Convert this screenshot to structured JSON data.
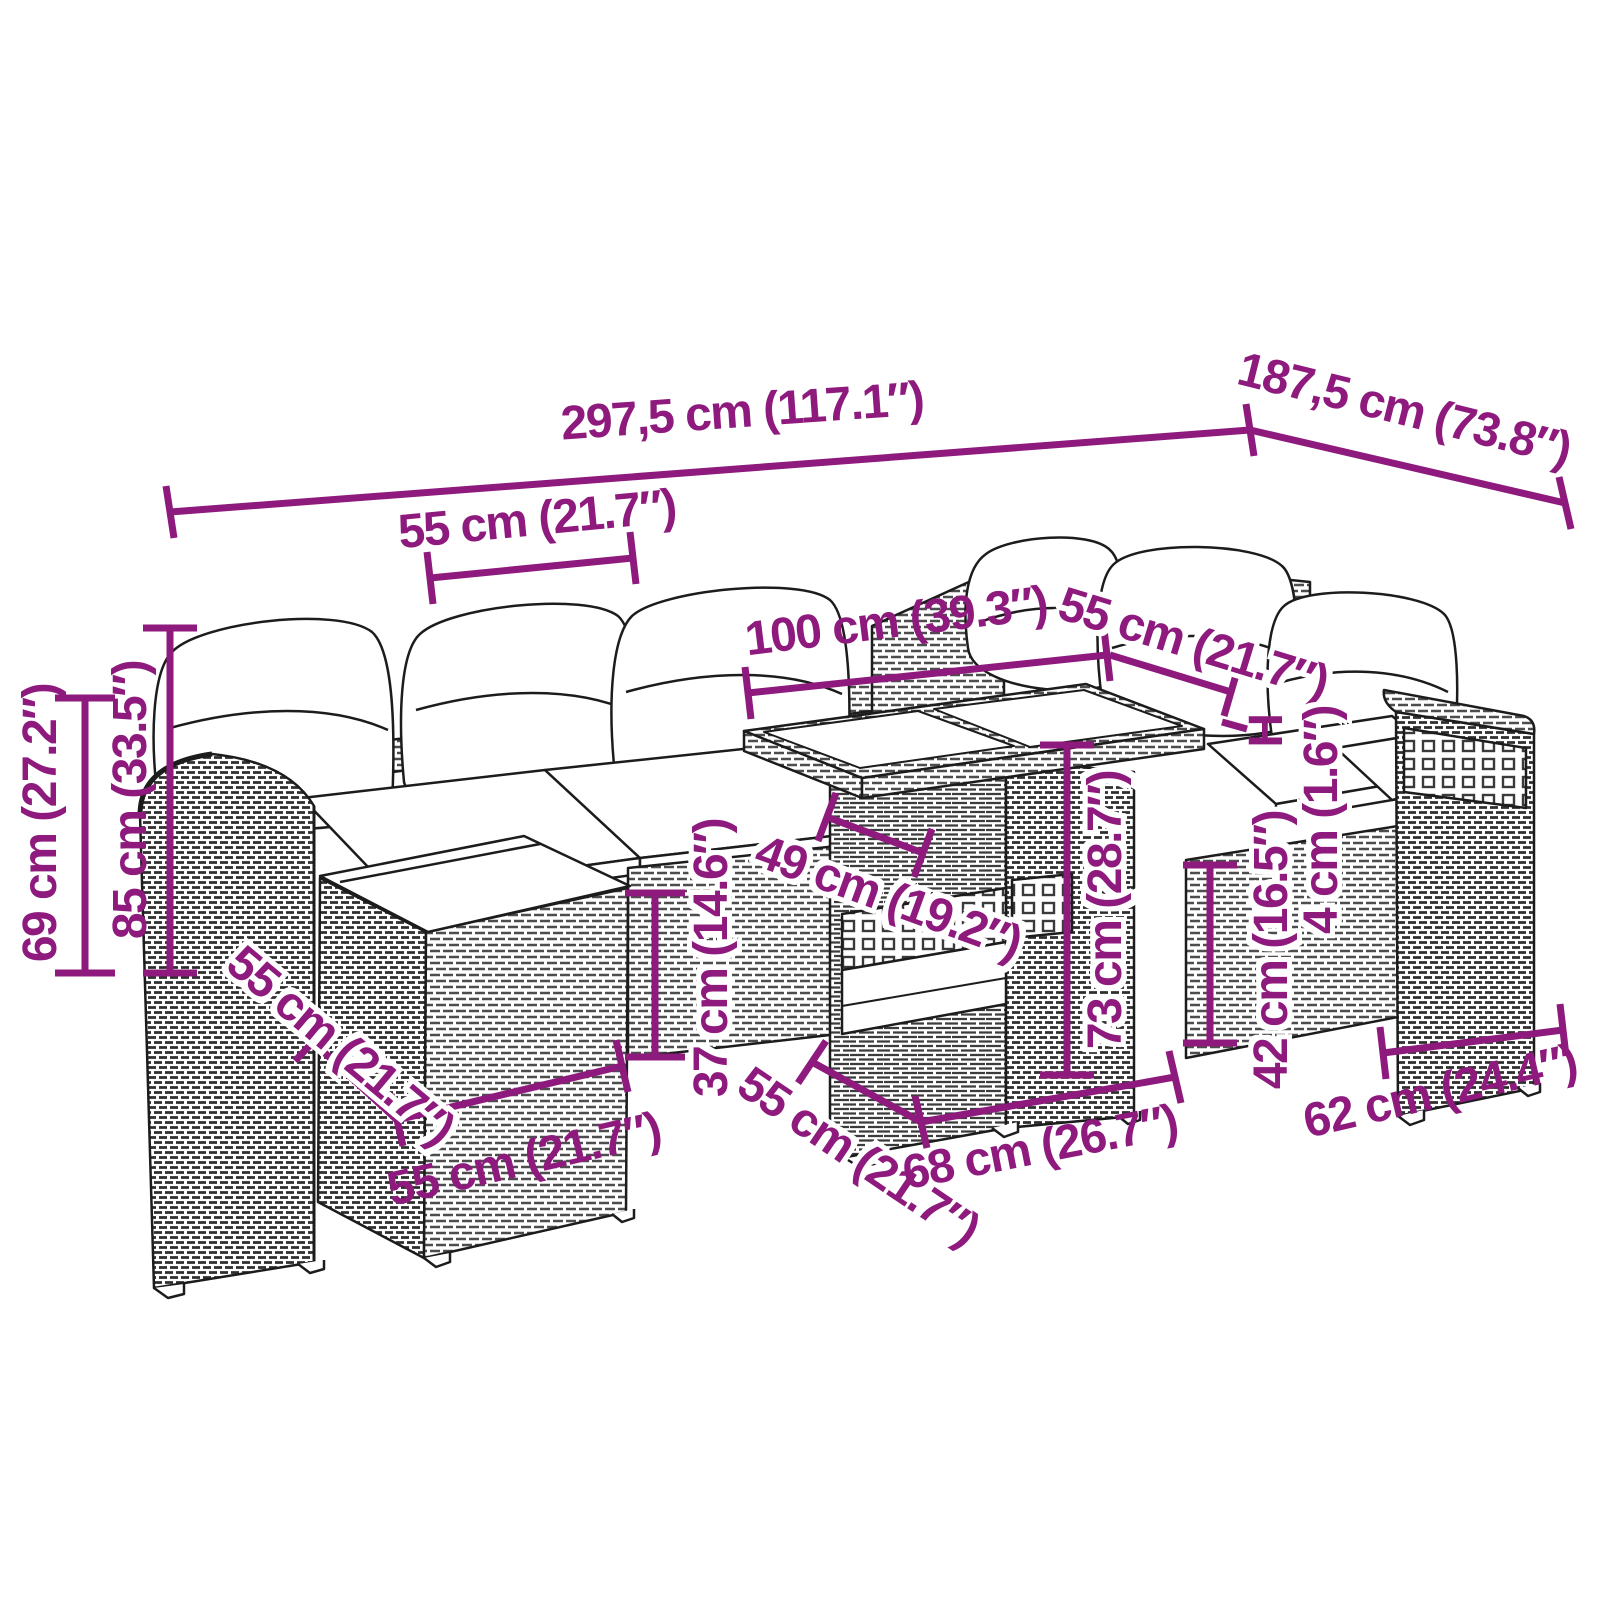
{
  "figure": {
    "type": "product-dimension-diagram",
    "subject": "rattan garden lounge set with ottoman and glass-top table"
  },
  "colors": {
    "dimension_accent": "#8E1A7E",
    "line_art": "#1c1c1c",
    "background": "#ffffff"
  },
  "dims": {
    "overall_width": {
      "text": "297,5 cm (117.1″)"
    },
    "overall_depth": {
      "text": "187,5 cm (73.8″)"
    },
    "backrest_module_width": {
      "text": "55 cm (21.7″)"
    },
    "armrest_height": {
      "text": "69 cm (27.2″)"
    },
    "total_height": {
      "text": "85 cm (33.5″)"
    },
    "ottoman_depth": {
      "text": "55 cm (21.7″)"
    },
    "ottoman_width": {
      "text": "55 cm (21.7″)"
    },
    "ottoman_height": {
      "text": "37 cm (14.6″)"
    },
    "table_top_module": {
      "text": "49 cm (19.2″)"
    },
    "table_width": {
      "text": "100 cm (39.3″)"
    },
    "corner_module_width": {
      "text": "55 cm (21.7″)"
    },
    "height_marker": {
      "text": "H"
    },
    "tabletop_gap": {
      "text": "4 cm (1.6″)"
    },
    "table_height": {
      "text": "73 cm (28.7″)"
    },
    "table_depth": {
      "text": "55 cm (21.7″)"
    },
    "table_base_width": {
      "text": "68 cm (26.7″)"
    },
    "seat_height": {
      "text": "42 cm (16.5″)"
    },
    "armchair_width": {
      "text": "62 cm (24.4″)"
    }
  }
}
